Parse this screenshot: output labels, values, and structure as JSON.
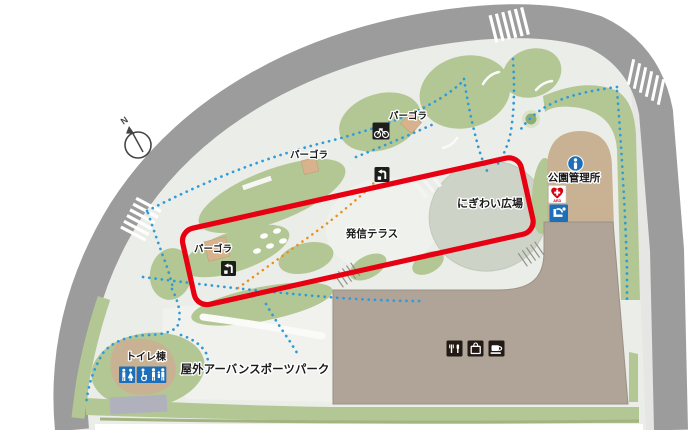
{
  "labels": {
    "compass_n": "N",
    "pergola_1": "パーゴラ",
    "pergola_2": "パーゴラ",
    "pergola_3": "パーゴラ",
    "park_office": "公園管理所",
    "nigiwai_plaza": "にぎわい広場",
    "hasshin_terrace": "発信テラス",
    "toilet_building": "トイレ棟",
    "urban_sports_park": "屋外アーバンスポーツパーク",
    "aed": "AED"
  },
  "icons": {
    "compass": "N-arrow",
    "info": "i",
    "aed": "heart-cross",
    "drinking_fountain": "fountain",
    "toilet": "man-woman",
    "accessible_family": "wheelchair-family",
    "bicycle": "bicycle",
    "stairs": "stairs-arrow",
    "restaurant": "fork-knife",
    "shop": "shopping-bag",
    "cafe": "coffee-cup"
  },
  "colors": {
    "road": "#9c9c9c",
    "sidewalk": "#e6e7e4",
    "ground": "#ebede8",
    "ground_light": "#f1f2ee",
    "terrace": "#eff1ec",
    "plaza": "#cdd3c6",
    "green": "#b3c794",
    "green_dark": "#a3b483",
    "tree_outer": "#d9e3c8",
    "tree_inner": "#8fae77",
    "tan": "#c9b294",
    "pergola": "#d7b28d",
    "building": "#afa497",
    "building_edge": "#9a9183",
    "gray_block": "#b0b1bd",
    "red": "#e60012",
    "path_blue": "#2f9bd8",
    "path_orange": "#e98f1f",
    "icon_blue": "#1c6fb8",
    "icon_black": "#1d1d1b",
    "icon_brown": "#231a14",
    "aed_red": "#d7000f",
    "text": "#1a1a1a"
  }
}
